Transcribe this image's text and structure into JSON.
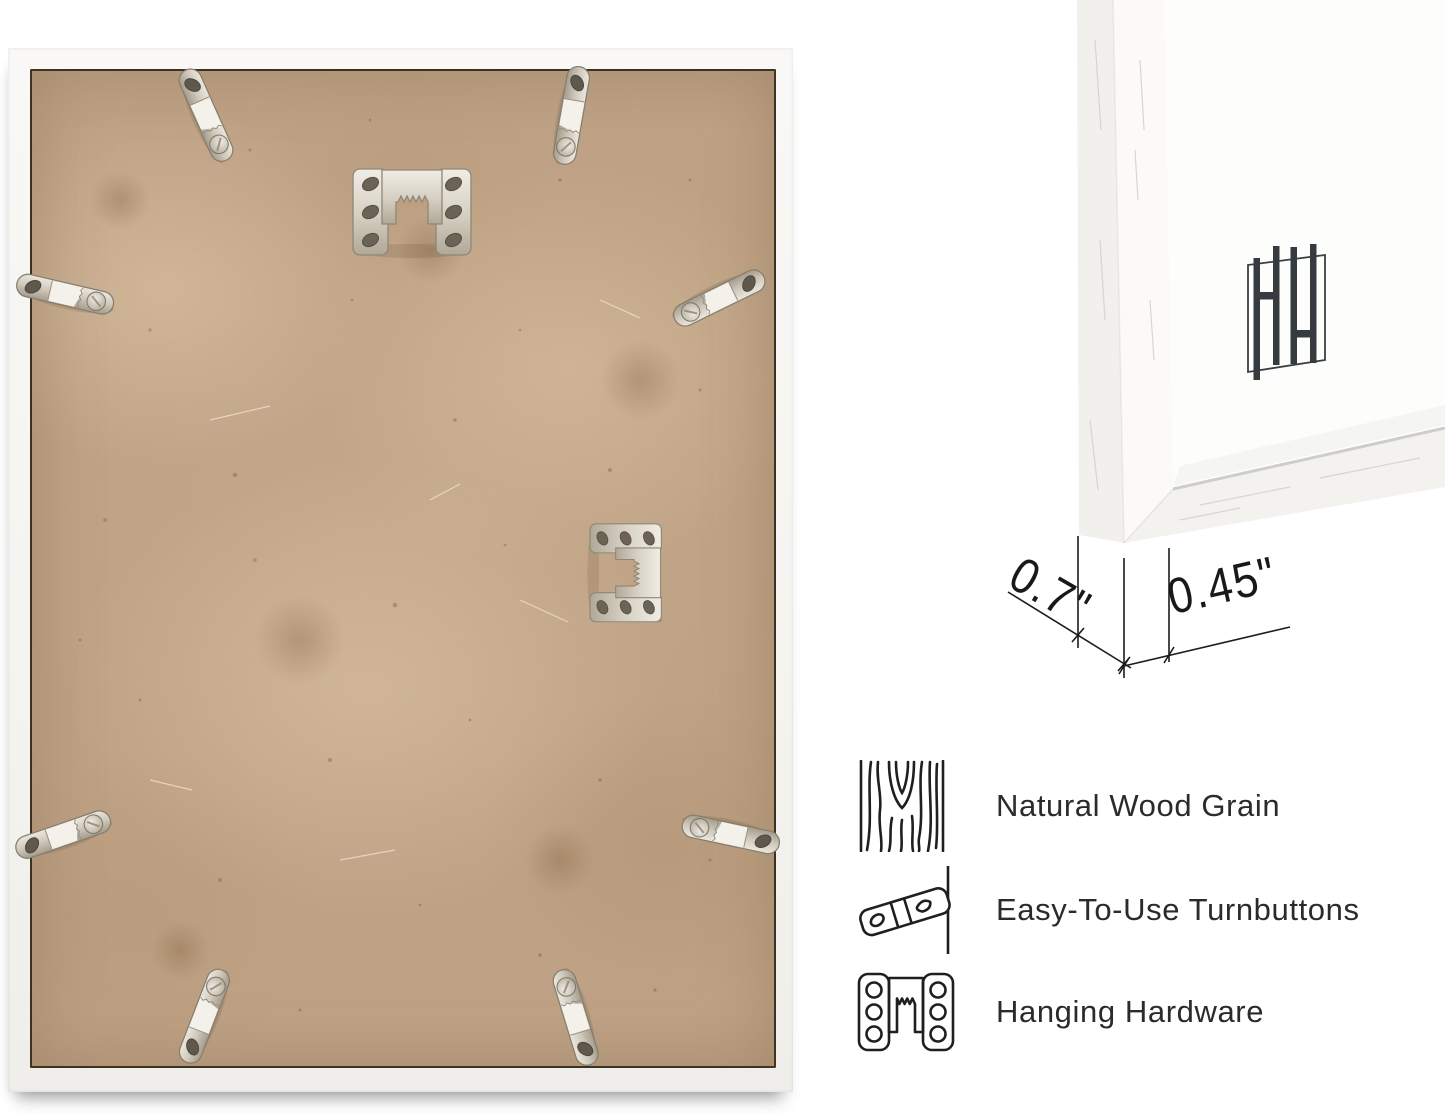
{
  "page": {
    "background": "#ffffff"
  },
  "back_view": {
    "backing_color": "#bfa285",
    "frame_color": "#f7f6f3",
    "turnbutton_count": 8,
    "sawtooth_hanger_count": 2
  },
  "corner_view": {
    "logo_monogram": "HH",
    "dimension_depth": "0.7\"",
    "dimension_face": "0.45\""
  },
  "features": [
    {
      "icon": "wood-grain-icon",
      "label": "Natural Wood Grain"
    },
    {
      "icon": "turnbutton-icon",
      "label": "Easy-To-Use Turnbuttons"
    },
    {
      "icon": "hanging-hardware-icon",
      "label": "Hanging Hardware"
    }
  ],
  "colors": {
    "metal": "#cdc6b9",
    "hairline": "#352a1c",
    "text": "#2b2b2b",
    "logo": "#363b40"
  }
}
